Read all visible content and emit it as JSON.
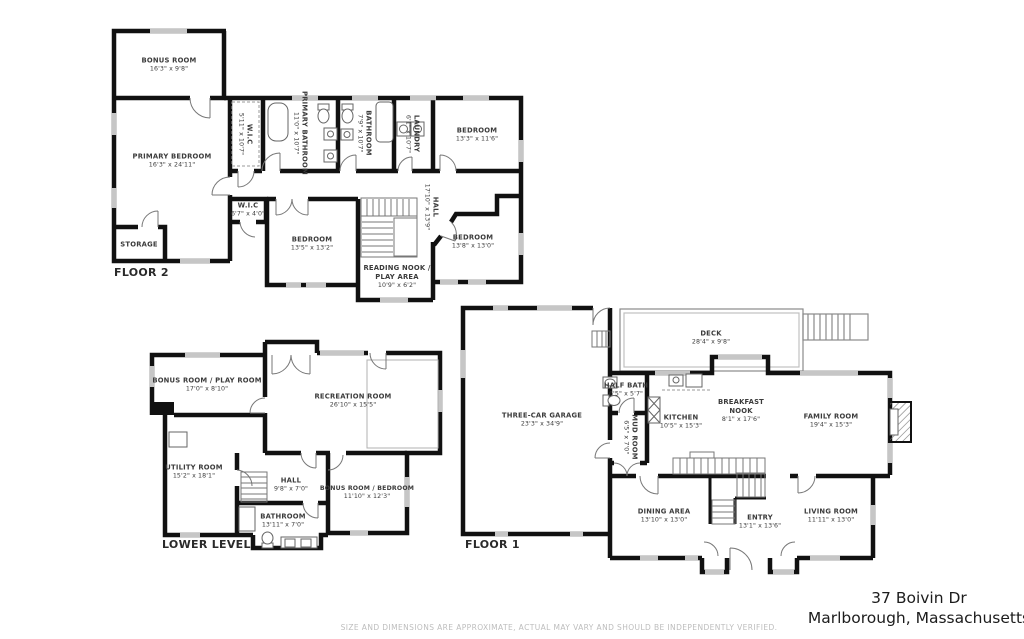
{
  "address": {
    "line1": "37 Boivin Dr",
    "line2": "Marlborough, Massachusetts"
  },
  "disclaimer": "SIZE AND DIMENSIONS ARE APPROXIMATE, ACTUAL MAY VARY AND SHOULD BE INDEPENDENTLY VERIFIED.",
  "colors": {
    "wall": "#111111",
    "window": "#c6c6c6",
    "label_text": "#3b3b3b",
    "disclaimer_text": "#bdbdbd",
    "background": "#ffffff"
  },
  "floors": [
    {
      "title": "FLOOR 2",
      "rooms": [
        {
          "label": "BONUS ROOM",
          "dims": "16'3\" x 9'8\""
        },
        {
          "label": "PRIMARY BEDROOM",
          "dims": "16'3\" x 24'11\""
        },
        {
          "label": "W.I.C",
          "dims": "5'11\" x 10'7\""
        },
        {
          "label": "PRIMARY BATHROOM",
          "dims": "11'0\" x 10'7\""
        },
        {
          "label": "BATHROOM",
          "dims": "7'9\" x 10'7\""
        },
        {
          "label": "LAUNDRY",
          "dims": "6'1\" x 10'7\""
        },
        {
          "label": "BEDROOM",
          "dims": "13'3\" x 11'6\""
        },
        {
          "label": "W.I.C",
          "dims": "6'7\" x 4'0\""
        },
        {
          "label": "STORAGE",
          "dims": ""
        },
        {
          "label": "BEDROOM",
          "dims": "13'5\" x 13'2\""
        },
        {
          "label": "READING NOOK / PLAY AREA",
          "dims": "10'9\" x 6'2\""
        },
        {
          "label": "HALL",
          "dims": "17'10\" x 13'9\""
        },
        {
          "label": "BEDROOM",
          "dims": "13'8\" x 13'0\""
        }
      ]
    },
    {
      "title": "LOWER LEVEL",
      "rooms": [
        {
          "label": "BONUS ROOM / PLAY ROOM",
          "dims": "17'0\" x 8'10\""
        },
        {
          "label": "RECREATION ROOM",
          "dims": "26'10\" x 15'5\""
        },
        {
          "label": "UTILITY ROOM",
          "dims": "15'2\" x 18'1\""
        },
        {
          "label": "HALL",
          "dims": "9'8\" x 7'0\""
        },
        {
          "label": "BONUS ROOM / BEDROOM",
          "dims": "11'10\" x 12'3\""
        },
        {
          "label": "BATHROOM",
          "dims": "13'11\" x 7'0\""
        }
      ]
    },
    {
      "title": "FLOOR 1",
      "rooms": [
        {
          "label": "THREE-CAR GARAGE",
          "dims": "23'3\" x 34'9\""
        },
        {
          "label": "DECK",
          "dims": "28'4\" x 9'8\""
        },
        {
          "label": "HALF BATH",
          "dims": "6'5\" x 5'7\""
        },
        {
          "label": "KITCHEN",
          "dims": "10'5\" x 15'3\""
        },
        {
          "label": "BREAKFAST NOOK",
          "dims": "8'1\" x 17'6\""
        },
        {
          "label": "FAMILY ROOM",
          "dims": "19'4\" x 15'3\""
        },
        {
          "label": "MUD ROOM",
          "dims": "6'5\" x 7'0\""
        },
        {
          "label": "DINING AREA",
          "dims": "13'10\" x 13'0\""
        },
        {
          "label": "ENTRY",
          "dims": "13'1\" x 13'6\""
        },
        {
          "label": "LIVING ROOM",
          "dims": "11'11\" x 13'0\""
        }
      ]
    }
  ]
}
